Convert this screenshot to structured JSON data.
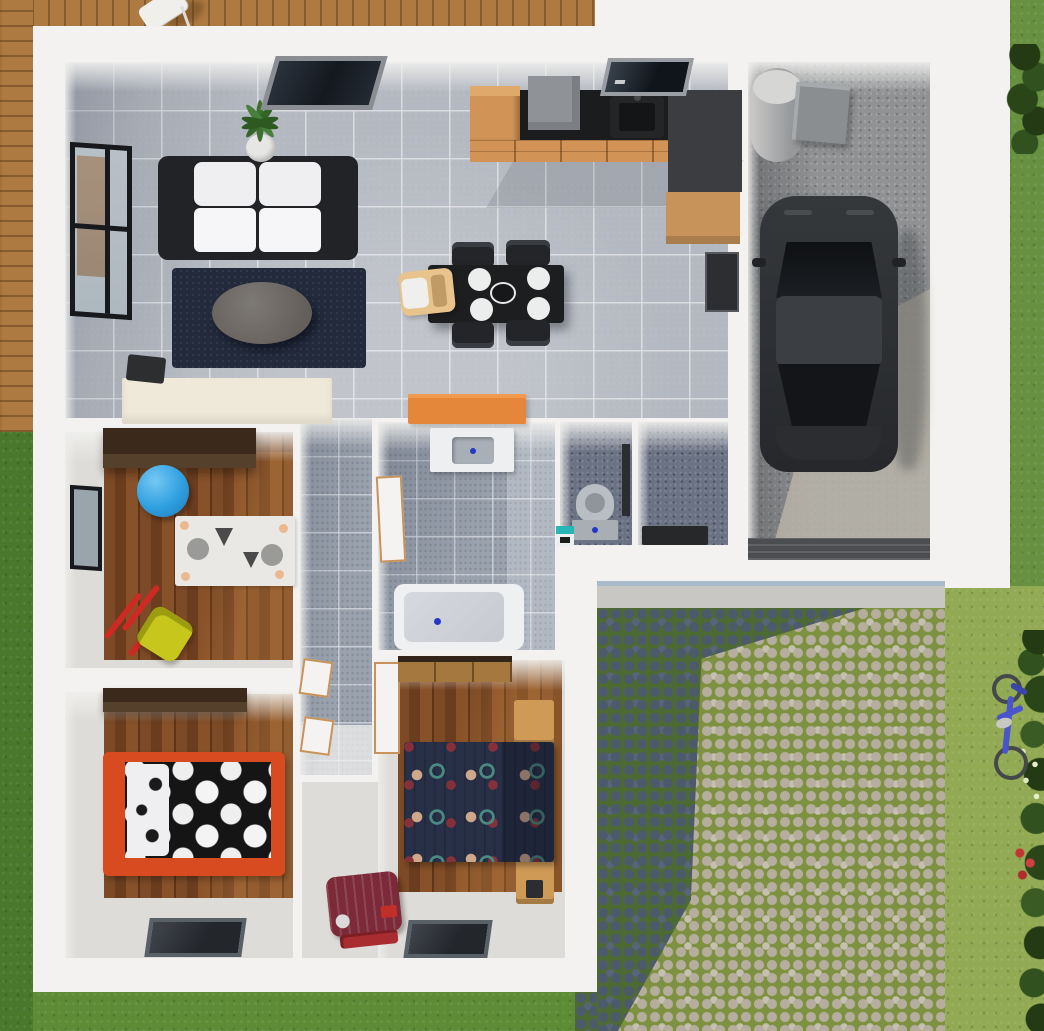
{
  "scene": {
    "view": "top-down-3d-architectural-floorplan-render",
    "outdoor": {
      "areas": [
        "lawn",
        "wooden-deck",
        "cobblestone-driveway",
        "concrete-sidewalk",
        "garden-bushes"
      ],
      "objects": [
        "deck-chair",
        "blue-bicycle",
        "red-flowers",
        "hedge"
      ]
    },
    "house": {
      "rooms": [
        {
          "id": "living-room",
          "floor": "gray-tile",
          "items": [
            "black-white-sofa",
            "round-coffee-table",
            "navy-area-rug",
            "potted-plant",
            "cream-sideboard",
            "black-speaker",
            "large-left-window",
            "top-skylight-window"
          ]
        },
        {
          "id": "kitchen",
          "floor": "gray-tile",
          "items": [
            "black-countertop",
            "wood-cabinet-drawers",
            "fridge-cabinet",
            "cooker-hood",
            "sink",
            "top-window",
            "dark-side-counter",
            "wall-panel",
            "black-dining-table",
            "white-plates",
            "center-bowl",
            "dining-chairs-x4",
            "wooden-high-chair",
            "orange-sideboard"
          ]
        },
        {
          "id": "garage",
          "floor": "concrete",
          "items": [
            "black-car",
            "water-heater-cylinder",
            "storage-box",
            "garage-door-strip"
          ]
        },
        {
          "id": "entry-hall",
          "floor": "dark-speckled-tile",
          "items": [
            "dark-doormat"
          ]
        },
        {
          "id": "wc",
          "floor": "dark-speckled-tile",
          "items": [
            "toilet",
            "teal-waste-bin",
            "dark-wall-strip"
          ]
        },
        {
          "id": "bathroom",
          "floor": "gray-tile",
          "items": [
            "vanity-sink",
            "bathtub",
            "white-door"
          ]
        },
        {
          "id": "hallway",
          "floor": "gray-tile",
          "items": [
            "white-doors-wood-trim-x3"
          ]
        },
        {
          "id": "nursery",
          "floor": "wood-plank",
          "items": [
            "dark-wardrobe",
            "blue-gym-ball",
            "zebra-play-rug",
            "yellow-toy-wheelbarrow",
            "left-window"
          ]
        },
        {
          "id": "bedroom-1",
          "floor": "wood-plank",
          "items": [
            "dark-wardrobe",
            "red-frame-bed",
            "black-polka-dot-duvet",
            "white-pillows",
            "bottom-window"
          ]
        },
        {
          "id": "bedroom-2",
          "floor": "wood-plank",
          "items": [
            "wood-wardrobe",
            "double-bed-navy-dot-duvet",
            "nightstand-top",
            "nightstand-bottom",
            "burgundy-suitcase",
            "bottom-window"
          ]
        }
      ]
    }
  },
  "palette": {
    "grass_base": "#5e8c36",
    "grass_dark": "#4a782c",
    "grass_right": "#93aa54",
    "grass_right_top": "#679140",
    "deck_wood": "#ad7a41",
    "wall_white": "#f3f2f0",
    "tile_floor": "#b4b8c0",
    "tile_grout": "#dadce0",
    "bath_tile": "#9aa2ae",
    "dark_tile": "#6a7283",
    "wood_floor": "#79481f",
    "floor_light": "#dedcd8",
    "concrete": "#909294",
    "concrete_lit": "#b7b3a8",
    "cobble_dark": "#4d5a6c",
    "cobble_dark_joint": "#4e6a33",
    "cobble_light": "#b5ae9e",
    "cobble_light_joint": "#7e9140",
    "sidewalk": "#c8c7c3",
    "sofa_frame": "#212326",
    "sofa_cushion": "#efeff1",
    "rug_navy": "#222a3c",
    "coffee_table": "#75716d",
    "plant_green": "#3f7030",
    "pot_white": "#e6e6e4",
    "cabinet_wood": "#d29356",
    "counter_black": "#1b1c1e",
    "counter_gray": "#3b3d41",
    "hood_gray": "#8f9297",
    "table_black": "#1d1e20",
    "plate_white": "#eceded",
    "highchair_wood": "#e8c48c",
    "sideboard_cream": "#efe9d9",
    "sideboard_orange": "#e5873b",
    "vanity_white": "#edeff1",
    "basin_gray": "#a9afb7",
    "tub_white": "#eef0f2",
    "tub_inner": "#c6cad0",
    "drain_blue": "#2438c8",
    "toilet_gray": "#b9bec4",
    "bin_teal": "#26b6b6",
    "wardrobe_dark": "#3b2a1b",
    "wardrobe_wood": "#a5783f",
    "nightstand_wood": "#cf9a56",
    "bed1_frame": "#d84a20",
    "bed1_duvet": "#151515",
    "bed2_duvet": "#283048",
    "suitcase_burgundy": "#7c2a3a",
    "ball_blue": "#2f9fe0",
    "toy_yellow": "#c6c61d",
    "toy_red": "#cc2a22",
    "car_body": "#2c2e30",
    "car_roof": "#3b3e42",
    "car_glass": "#131518",
    "cylinder_gray": "#b5b6b4",
    "box_gray": "#8b8e91",
    "window_frame": "#17191c",
    "glass_reflect": "#b7c0c6",
    "door_white": "#f4f3f1",
    "door_trim": "#c8935a",
    "mat_dark": "#26282a",
    "garage_door": "#4b4d50",
    "bike_blue": "#4a55cc",
    "bush_dark": "#2c4418"
  }
}
